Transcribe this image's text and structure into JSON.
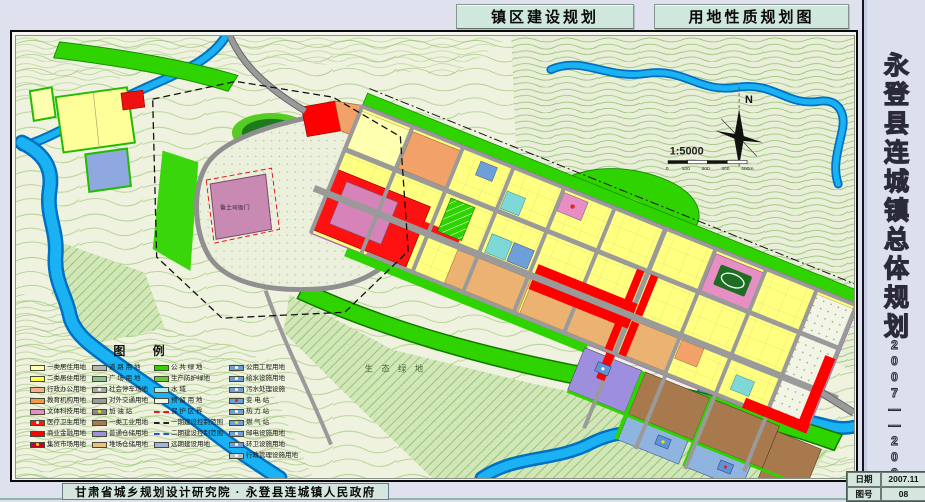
{
  "header": {
    "tab_left": "镇区建设规划",
    "tab_right": "用地性质规划图"
  },
  "sidebar": {
    "title": "永登县连城镇总体规划",
    "period": "2007——2020",
    "date_label": "日期",
    "date_value": "2007.11",
    "sheet_label": "图号",
    "sheet_value": "08"
  },
  "footer": {
    "credit": "甘肃省城乡规划设计研究院 · 永登县连城镇人民政府"
  },
  "map": {
    "north_label": "N",
    "scale_text": "1:5000",
    "scale_ticks": [
      "0",
      "100",
      "200",
      "300",
      "400m"
    ],
    "labels": {
      "yamen": "鲁土司衙门",
      "eco": "生 态 绿 地"
    }
  },
  "legend": {
    "title": "图    例",
    "columns": [
      [
        {
          "color": "#ffffb0",
          "label": "一类居住用地"
        },
        {
          "color": "#ffff45",
          "label": "二类居住用地"
        },
        {
          "color": "#f5b087",
          "label": "行政办公用地"
        },
        {
          "color": "#f2994d",
          "label": "教育机构用地"
        },
        {
          "color": "#e78fc5",
          "label": "文体科技用地"
        },
        {
          "color": "#ff1414",
          "label": "医疗卫生用地",
          "dot": "#ffffff"
        },
        {
          "color": "#ff0000",
          "label": "商业金融用地"
        },
        {
          "color": "#c40028",
          "label": "集贸市场用地",
          "dot": "#ffe000"
        }
      ],
      [
        {
          "color": "#b5b5b5",
          "label": "道 路 用 地"
        },
        {
          "color": "#8fbf95",
          "label": "广 场 用 地"
        },
        {
          "color": "#a8a8a8",
          "label": "社会停车场地",
          "dot": "#ffffff"
        },
        {
          "color": "#9a9a9a",
          "label": "对外交通用地"
        },
        {
          "color": "#8a8a8a",
          "label": "加 油 站",
          "dot": "#ffe000"
        },
        {
          "color": "#a9794e",
          "label": "一类工业用地"
        },
        {
          "color": "#9d8fdd",
          "label": "普通仓储用地"
        },
        {
          "color": "#e9c27e",
          "label": "堆场仓储用地"
        }
      ],
      [
        {
          "color": "#2fd400",
          "label": "公 共 绿 地"
        },
        {
          "color": "#6fc832",
          "label": "生产防护绿地"
        },
        {
          "color": "#aceefc",
          "label": "水 域"
        },
        {
          "color": "#f2f5e6",
          "label": "预 留 用 地"
        },
        {
          "line": "#e81818",
          "label": "保 护 区 界"
        },
        {
          "line": "#222222",
          "label": "一期建设控制范围"
        },
        {
          "line": "#2255dd",
          "label": "二期建设控制范围"
        },
        {
          "color": "#9fb6d9",
          "label": "远期建设用地"
        }
      ],
      [
        {
          "color": "#6f9fd8",
          "label": "公用工程用地",
          "dot": "#ffffff"
        },
        {
          "color": "#6f9fd8",
          "label": "给水设施用地",
          "dot": "#ffffff"
        },
        {
          "color": "#6f9fd8",
          "label": "污水处理设施",
          "dot": "#ffffff"
        },
        {
          "color": "#6f9fd8",
          "label": "变 电 站",
          "dot": "#e82222"
        },
        {
          "color": "#6f9fd8",
          "label": "热 力 站",
          "dot": "#ffffff"
        },
        {
          "color": "#6f9fd8",
          "label": "燃 气 站",
          "dot": "#ffe000"
        },
        {
          "color": "#6f9fd8",
          "label": "邮电设施用地",
          "dot": "#ffffff"
        },
        {
          "color": "#6f9fd8",
          "label": "环卫设施用地",
          "dot": "#ffffff"
        },
        {
          "color": "#b9c3cc",
          "label": "行政管理设施用地",
          "dot": "#ffffff"
        }
      ]
    ]
  },
  "colors": {
    "page_bg": "#dfe2ee",
    "tab_bg": "#cfe7dc",
    "map_bg": "#eef2de",
    "contour": "#a9cc86",
    "river": "#18b0f0",
    "green_belt": "#2fd400",
    "road": "#9a9a9a",
    "residential": "#ffff80",
    "commercial": "#ff0000",
    "cultural": "#e78fc5",
    "industrial": "#a9794e",
    "warehouse": "#9d8fdd",
    "utility": "#6f9fd8",
    "frame": "#0a0a0a"
  }
}
